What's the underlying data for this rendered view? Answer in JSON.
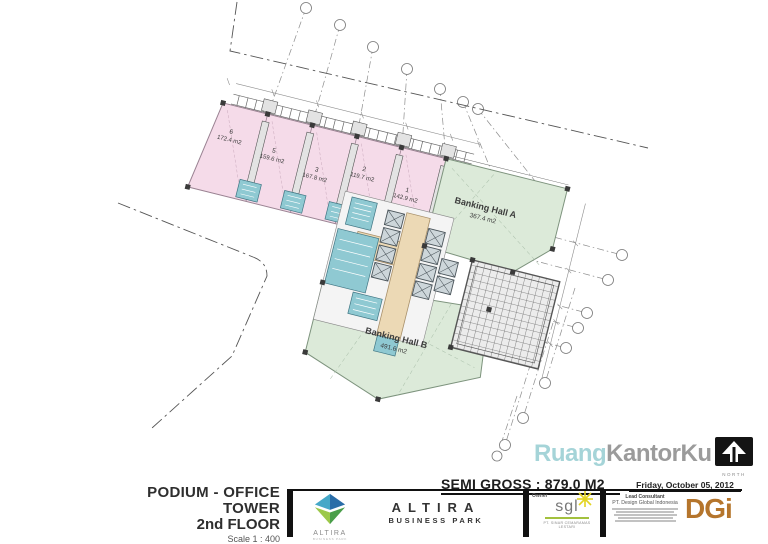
{
  "plan": {
    "units": [
      {
        "number": "6",
        "area": "172.4 m2"
      },
      {
        "number": "5",
        "area": "159.6 m2"
      },
      {
        "number": "3",
        "area": "167.8 m2"
      },
      {
        "number": "2",
        "area": "119.7 m2"
      },
      {
        "number": "1",
        "area": "142.9 m2"
      }
    ],
    "halls": [
      {
        "name": "Banking Hall A",
        "area": "367.4 m2"
      },
      {
        "name": "Banking Hall B",
        "area": "491.6 m2"
      }
    ],
    "colors": {
      "unit_fill": "#f5dbe9",
      "hall_fill": "#dcead9",
      "core_teal": "#8fc9d2",
      "corridor": "#ecd9b5"
    }
  },
  "title_block": {
    "project_title_line1": "PODIUM - OFFICE TOWER",
    "project_title_line2": "2nd FLOOR",
    "scale": "Scale 1 : 400",
    "semi_gross": "SEMI GROSS : 879.0 M2",
    "date": "Friday, October 05, 2012",
    "brand": {
      "logo_text": "ALTIRA",
      "logo_sub": "BUSINESS PARK",
      "name": "ALTIRA",
      "subtitle": "BUSINESS PARK"
    },
    "owner": {
      "label": "Owner",
      "logo_text": "sgl",
      "company": "PT. SINAR CEMARAMAS LESTARI"
    },
    "consultant": {
      "label": "Lead Consultant",
      "company": "PT. Design Global Indonesia",
      "logo_text": "DGi"
    },
    "watermark": {
      "part1": "Ruang",
      "part2": "KantorKu"
    },
    "north_label": "NORTH"
  }
}
